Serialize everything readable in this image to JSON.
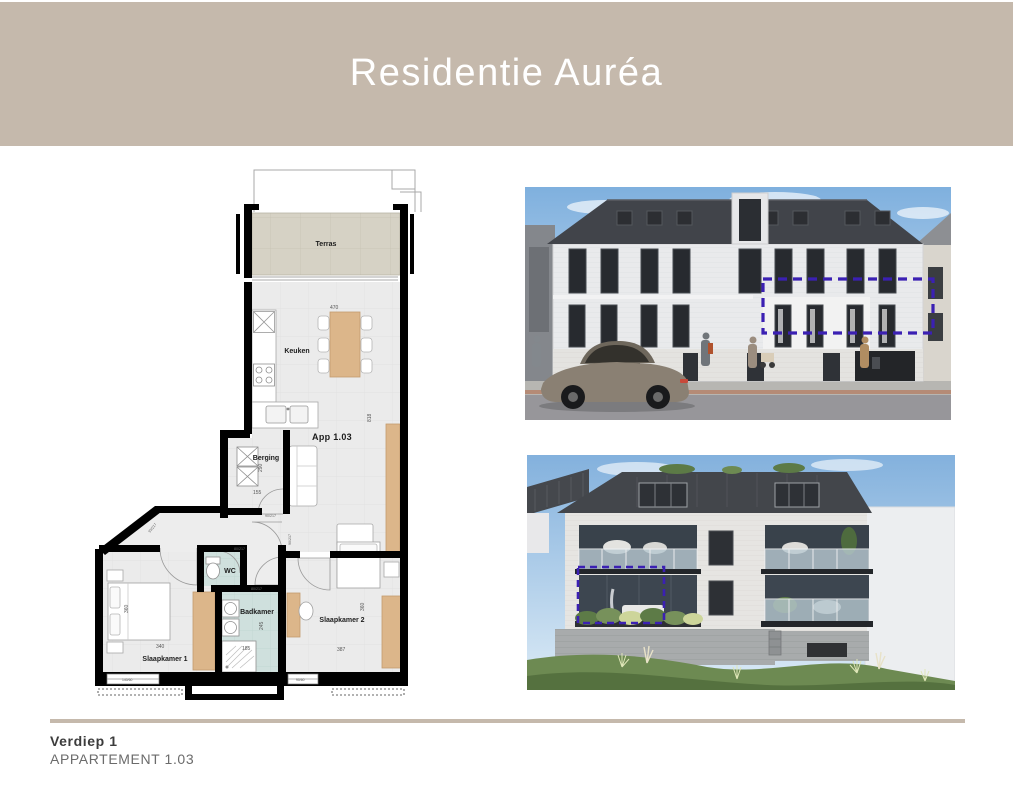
{
  "header": {
    "title": "Residentie Auréa",
    "bg_color": "#c5b9ac",
    "text_color": "#ffffff"
  },
  "footer": {
    "floor_label": "Verdiep 1",
    "apartment_label": "APPARTEMENT 1.03",
    "divider_color": "#c5b9ac"
  },
  "floor_plan": {
    "apartment_label": "App 1.03",
    "rooms": {
      "terras": "Terras",
      "keuken": "Keuken",
      "berging": "Berging",
      "wc": "WC",
      "badkamer": "Badkamer",
      "slaapkamer1": "Slaapkamer 1",
      "slaapkamer2": "Slaapkamer 2"
    },
    "dimensions": {
      "dining_width": "470",
      "living_length": "818",
      "berging_depth": "290",
      "berging_width": "155",
      "sk1_depth": "360",
      "sk1_width": "340",
      "badkamer_depth": "245",
      "badkamer_width": "185",
      "sk2_depth": "360",
      "sk2_width": "387"
    },
    "door_labels": {
      "berging": "90/217",
      "wc": "80/217",
      "badkamer": "80/217",
      "sk2": "90/217",
      "entrance": "93/217"
    },
    "window_labels": {
      "sk1": "140/60",
      "sk2": "90/60"
    },
    "colors": {
      "wall": "#000000",
      "room_floor": "#ebebeb",
      "wet_floor": "#cfe0dd",
      "terrace_floor": "#d6d2c5",
      "wood": "#dcb68a"
    }
  },
  "renders": {
    "highlight_color": "#3b20b3"
  }
}
